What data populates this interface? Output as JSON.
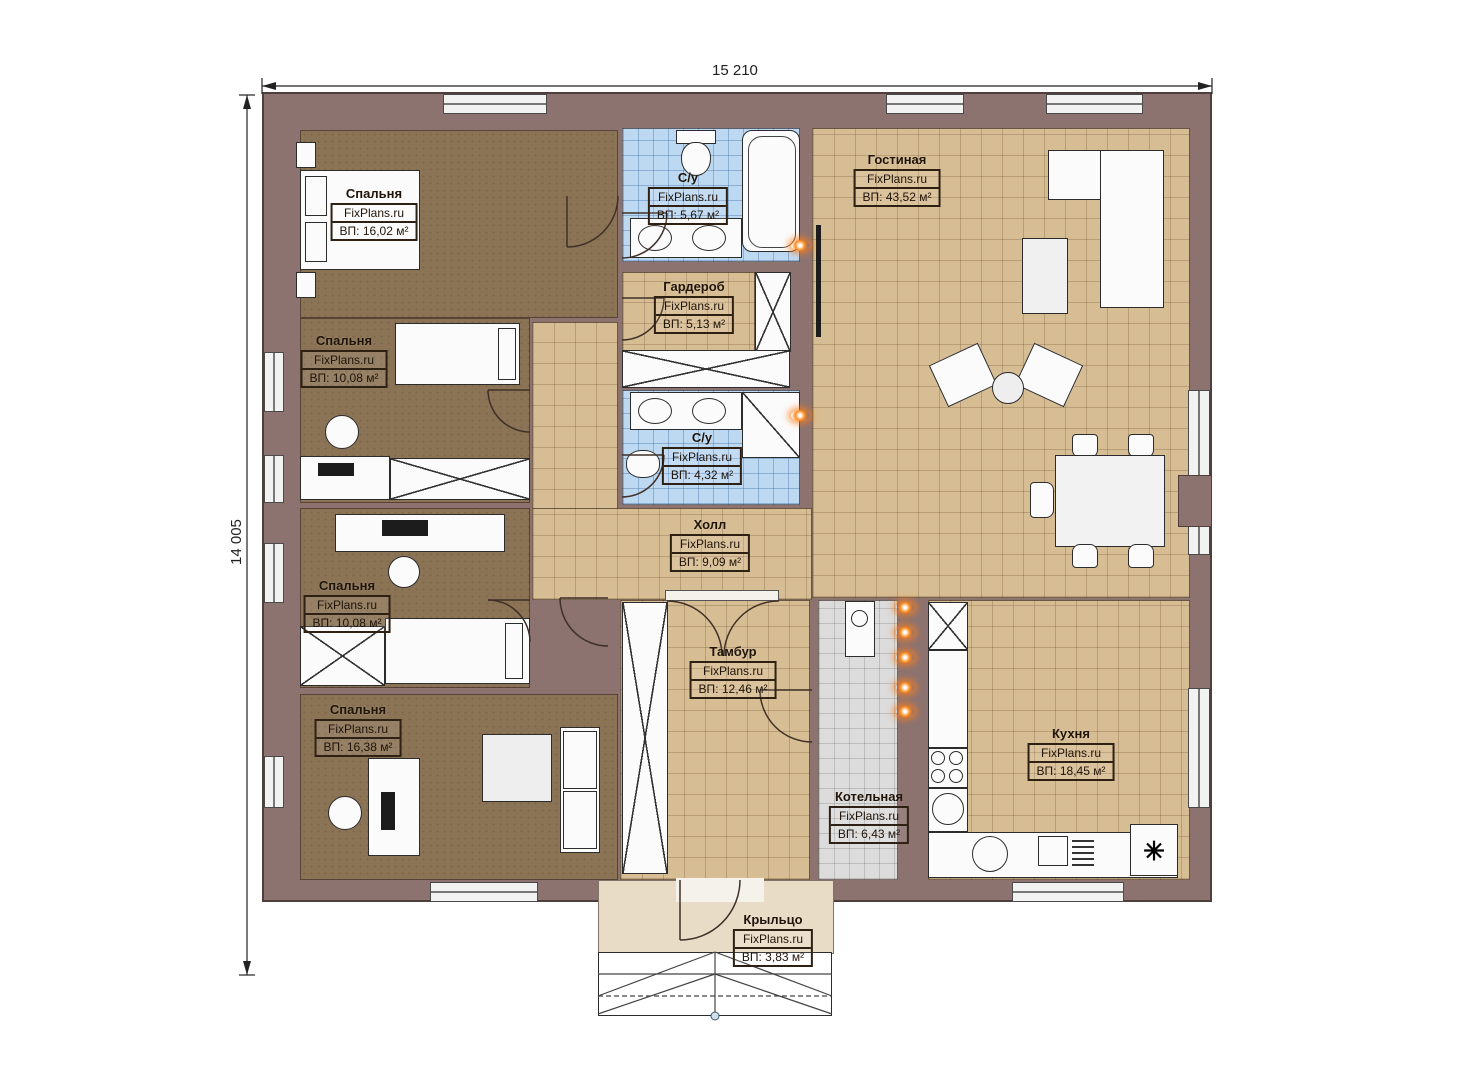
{
  "plan": {
    "title": "Одноэтажный дом — план",
    "brand": "FixPlans.ru",
    "dimensions": {
      "width_label": "15 210",
      "height_label": "14 005"
    },
    "colors": {
      "wall": "#8c7370",
      "bedroom_floor": "#8b7355",
      "tile_floor": "#d7bd93",
      "bath_floor": "#bdd9f2",
      "boiler_floor": "#dcdcdc",
      "porch_floor": "#e9dcc7",
      "utility_marker": "#ff8a1e"
    },
    "fridge_symbol": "✳"
  },
  "rooms": [
    {
      "name": "Спальня",
      "brand": "FixPlans.ru",
      "area": "ВП: 16,02 м²"
    },
    {
      "name": "Спальня",
      "brand": "FixPlans.ru",
      "area": "ВП: 10,08 м²"
    },
    {
      "name": "Спальня",
      "brand": "FixPlans.ru",
      "area": "ВП: 10,08 м²"
    },
    {
      "name": "Спальня",
      "brand": "FixPlans.ru",
      "area": "ВП: 16,38 м²"
    },
    {
      "name": "С/у",
      "brand": "FixPlans.ru",
      "area": "ВП: 5,67 м²"
    },
    {
      "name": "Гардероб",
      "brand": "FixPlans.ru",
      "area": "ВП: 5,13 м²"
    },
    {
      "name": "С/у",
      "brand": "FixPlans.ru",
      "area": "ВП: 4,32 м²"
    },
    {
      "name": "Холл",
      "brand": "FixPlans.ru",
      "area": "ВП: 9,09 м²"
    },
    {
      "name": "Тамбур",
      "brand": "FixPlans.ru",
      "area": "ВП: 12,46 м²"
    },
    {
      "name": "Гостиная",
      "brand": "FixPlans.ru",
      "area": "ВП: 43,52 м²"
    },
    {
      "name": "Кухня",
      "brand": "FixPlans.ru",
      "area": "ВП: 18,45 м²"
    },
    {
      "name": "Котельная",
      "brand": "FixPlans.ru",
      "area": "ВП: 6,43 м²"
    },
    {
      "name": "Крыльцо",
      "brand": "FixPlans.ru",
      "area": "ВП: 3,83 м²"
    }
  ]
}
